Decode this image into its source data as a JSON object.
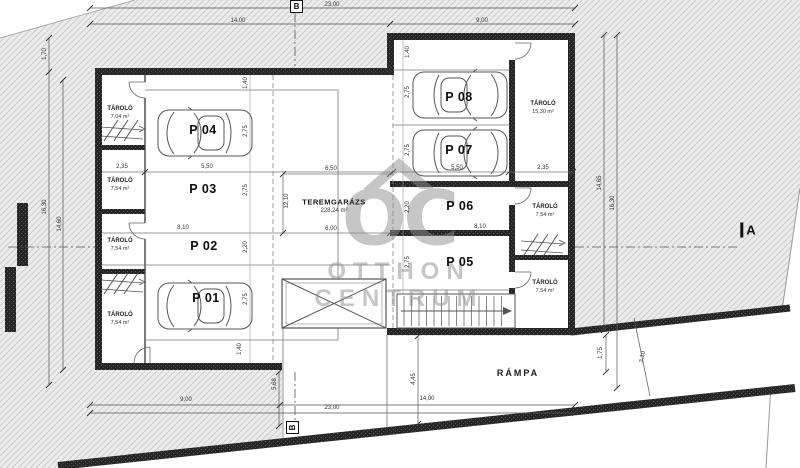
{
  "plan": {
    "hall": {
      "name": "TEREMGARÁZS",
      "area": "228,24 m²"
    },
    "ramp": {
      "label": "RÁMPA"
    },
    "watermark": {
      "logo": "OC",
      "line1": "OTTHON",
      "line2": "CENTRUM"
    },
    "sections": {
      "a": "A",
      "b": "B"
    },
    "parking": [
      {
        "label": "P 01"
      },
      {
        "label": "P 02"
      },
      {
        "label": "P 03"
      },
      {
        "label": "P 04"
      },
      {
        "label": "P 05"
      },
      {
        "label": "P 06"
      },
      {
        "label": "P 07"
      },
      {
        "label": "P 08"
      }
    ],
    "storage": [
      {
        "name": "TÁROLÓ",
        "area": "7,04 m²"
      },
      {
        "name": "TÁROLÓ",
        "area": "7,54 m²"
      },
      {
        "name": "TÁROLÓ",
        "area": "7,54 m²"
      },
      {
        "name": "TÁROLÓ",
        "area": "7,54 m²"
      },
      {
        "name": "TÁROLÓ",
        "area": "15,30 m²"
      },
      {
        "name": "TÁROLÓ",
        "area": "7,54 m²"
      },
      {
        "name": "TÁROLÓ",
        "area": "7,54 m²"
      }
    ],
    "dims": {
      "top23": "23,00",
      "top14": "14,00",
      "top9": "9,00",
      "left170": "1,70",
      "left1630": "16,30",
      "left1460": "14,60",
      "right1465": "14,65",
      "right1630": "16,30",
      "right175": "1,75",
      "right310": "3,10",
      "bottom9": "9,00",
      "bottom14": "14,00",
      "bottom23": "23,00",
      "b445": "4,45",
      "b568": "5,68",
      "l140a": "1,40",
      "l275a": "2,75",
      "l275b": "2,75",
      "l220": "2,20",
      "l275c": "2,75",
      "l140b": "1,40",
      "l235": "2,35",
      "l550": "5,50",
      "l810": "8,10",
      "c650": "6,50",
      "c600": "6,00",
      "c1210": "12,10",
      "r140": "1,40",
      "r275a": "2,75",
      "r275b": "2,75",
      "r220": "2,20",
      "r275c": "2,75",
      "r550": "5,50",
      "r235": "2,35",
      "r810": "8,10"
    }
  }
}
